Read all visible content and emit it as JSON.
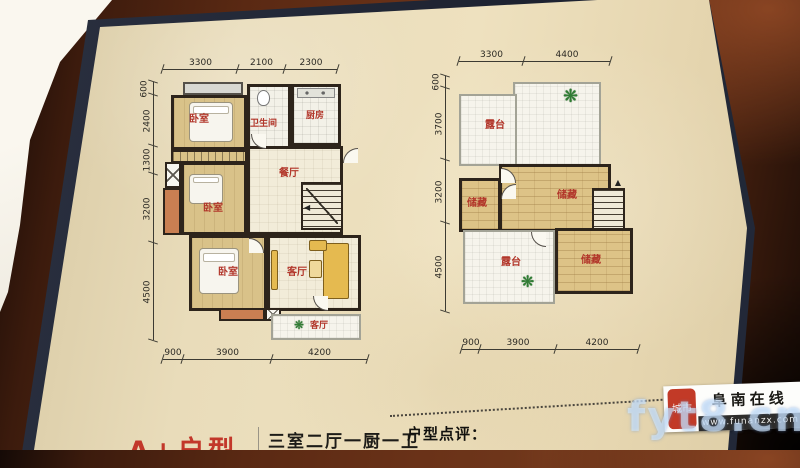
{
  "footer": {
    "title_red": "A+户型",
    "subtitle": "三室二厅一厨一卫",
    "review_label": "户型点评："
  },
  "plans": [
    {
      "name": "first-floor",
      "dims_top": [
        "3300",
        "2100",
        "2300"
      ],
      "dims_left": [
        "600",
        "2400",
        "1300",
        "3200",
        "4500"
      ],
      "dims_bottom": [
        "900",
        "3900",
        "4200"
      ],
      "rooms": {
        "bedroom1": "卧室",
        "bathroom": "卫生间",
        "kitchen": "厨房",
        "dining": "餐厅",
        "bedroom2": "卧室",
        "bedroom3": "卧室",
        "living": "客厅",
        "balcony": "客厅"
      }
    },
    {
      "name": "second-floor",
      "dims_top": [
        "3300",
        "4400"
      ],
      "dims_left": [
        "600",
        "3700",
        "3200",
        "4500"
      ],
      "dims_bottom": [
        "900",
        "3900",
        "4200"
      ],
      "rooms": {
        "terrace_top": "露台",
        "storage_big": "储藏",
        "storage_small": "储藏",
        "terrace_bottom": "露台",
        "storage_bottom": "储藏"
      }
    }
  ],
  "watermark": {
    "seal": "城市",
    "site_name": "阜南在线",
    "site_url": "www.funanzx.com",
    "overlay": "fyt8.cn"
  },
  "icons": {
    "plant": "❋",
    "arrow_up": "▲",
    "arrow_left": "◀"
  },
  "colors": {
    "page_cream": "#e9dcba",
    "wood_brown": "#5a2913",
    "wall_black": "#2d241b",
    "room_tan": "#d9c289",
    "label_red": "#b2362a",
    "accent_orange": "#c97f52",
    "sofa_yellow": "#e5ba50",
    "page_edge_navy": "#232a3a"
  }
}
